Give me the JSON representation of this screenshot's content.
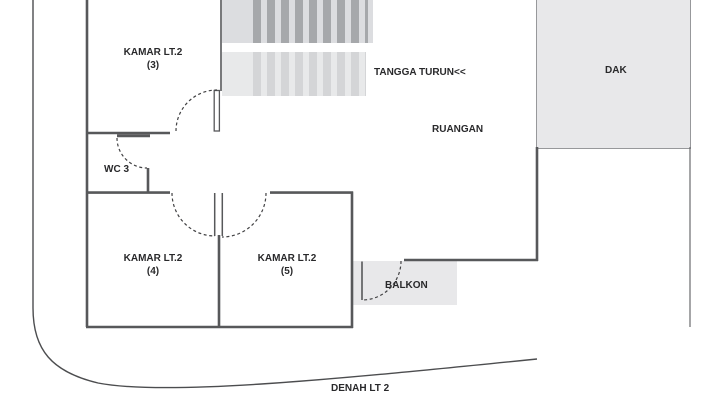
{
  "plan": {
    "caption": "DENAH LT 2",
    "rooms": {
      "kamar3": {
        "name": "KAMAR LT.2",
        "number": "(3)"
      },
      "kamar4": {
        "name": "KAMAR LT.2",
        "number": "(4)"
      },
      "kamar5": {
        "name": "KAMAR LT.2",
        "number": "(5)"
      },
      "wc3": {
        "name": "WC 3"
      },
      "ruangan": {
        "name": "RUANGAN"
      },
      "stairs": {
        "name": "TANGGA TURUN<<"
      },
      "dak": {
        "name": "DAK"
      },
      "balkon": {
        "name": "BALKON"
      }
    },
    "colors": {
      "wall": "#57585a",
      "boundary": "#4c4d4f",
      "door_arc": "#414143",
      "area_fill": "#e8e8ea",
      "stair_upper_bg": "#dcdde0",
      "stair_upper_stripe": "#a6a8ab",
      "stair_lower_bg": "#e8e9ea",
      "stair_lower_stripe": "#d4d5d7",
      "text": "#29292b"
    }
  }
}
